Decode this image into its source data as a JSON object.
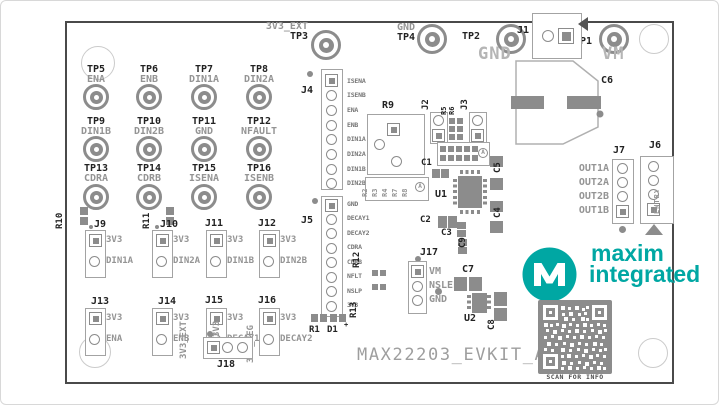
{
  "board": {
    "title": "MAX22203_EVKIT_A",
    "qr_caption": "SCAN FOR INFO",
    "logo": {
      "word1": "maxim",
      "word2": "integrated",
      "tm": "™"
    }
  },
  "testpoints": {
    "tp3": {
      "ref": "TP3",
      "signal": "3V3_EXT"
    },
    "tp4": {
      "ref": "TP4",
      "signal": "GND"
    },
    "tp2": {
      "ref": "TP2",
      "rail": "GND"
    },
    "tp1": {
      "ref": "TP1",
      "rail": "VM"
    },
    "grid": [
      {
        "ref": "TP5",
        "signal": "ENA"
      },
      {
        "ref": "TP6",
        "signal": "ENB"
      },
      {
        "ref": "TP7",
        "signal": "DIN1A"
      },
      {
        "ref": "TP8",
        "signal": "DIN2A"
      },
      {
        "ref": "TP9",
        "signal": "DIN1B"
      },
      {
        "ref": "TP10",
        "signal": "DIN2B"
      },
      {
        "ref": "TP11",
        "signal": "GND"
      },
      {
        "ref": "TP12",
        "signal": "NFAULT"
      },
      {
        "ref": "TP13",
        "signal": "CDRA"
      },
      {
        "ref": "TP14",
        "signal": "CDRB"
      },
      {
        "ref": "TP15",
        "signal": "ISENA"
      },
      {
        "ref": "TP16",
        "signal": "ISENB"
      }
    ]
  },
  "headers": {
    "j1": {
      "ref": "J1"
    },
    "j2": {
      "ref": "J2"
    },
    "j3": {
      "ref": "J3"
    },
    "j4": {
      "ref": "J4",
      "pins": [
        "ISENA",
        "ISENB",
        "ENA",
        "ENB",
        "DIN1A",
        "DIN2A",
        "DIN1B",
        "DIN2B"
      ]
    },
    "j5": {
      "ref": "J5",
      "pins": [
        "GND",
        "DECAY1",
        "DECAY2",
        "CDRA",
        "CDRB",
        "NFLT",
        "NSLP",
        "3V3"
      ]
    },
    "j6": {
      "ref": "J6",
      "label": "ENTRY"
    },
    "j7": {
      "ref": "J7",
      "pins": [
        "OUT1A",
        "OUT2A",
        "OUT2B",
        "OUT1B"
      ]
    },
    "j17": {
      "ref": "J17",
      "pins": [
        "VM",
        "NSLEEP",
        "GND"
      ]
    },
    "j18": {
      "ref": "J18",
      "pins": [
        "3V3_EXT",
        "3V3",
        "3V3_REG"
      ]
    }
  },
  "jumpers": [
    {
      "ref": "J9",
      "top": "3V3",
      "bottom": "DIN1A"
    },
    {
      "ref": "J10",
      "top": "3V3",
      "bottom": "DIN2A"
    },
    {
      "ref": "J11",
      "top": "3V3",
      "bottom": "DIN1B"
    },
    {
      "ref": "J12",
      "top": "3V3",
      "bottom": "DIN2B"
    },
    {
      "ref": "J13",
      "top": "3V3",
      "bottom": "ENA"
    },
    {
      "ref": "J14",
      "top": "3V3",
      "bottom": "ENB"
    },
    {
      "ref": "J15",
      "top": "3V3",
      "bottom": "DECAY1"
    },
    {
      "ref": "J16",
      "top": "3V3",
      "bottom": "DECAY2"
    }
  ],
  "components": {
    "r1": "R1",
    "d1": "D1",
    "d1_plus": "+",
    "r5": "R5",
    "r6": "R6",
    "r9": "R9",
    "r10": "R10",
    "r11": "R11",
    "r12": "R12",
    "r13": "R13",
    "r_block": [
      "R2",
      "R3",
      "R4",
      "R7",
      "R8"
    ],
    "u1": "U1",
    "u2": "U2",
    "c1": "C1",
    "c2": "C2",
    "c3": "C3",
    "c4": "C4",
    "c5": "C5",
    "c6": "C6",
    "c7": "C7",
    "c8": "C8",
    "c9": "C9",
    "assembly_mark": "A"
  },
  "colors": {
    "teal": "#00a7a3",
    "silk_dark": "#222222",
    "silk_gray": "#949494",
    "copper": "#8c8c8c"
  }
}
